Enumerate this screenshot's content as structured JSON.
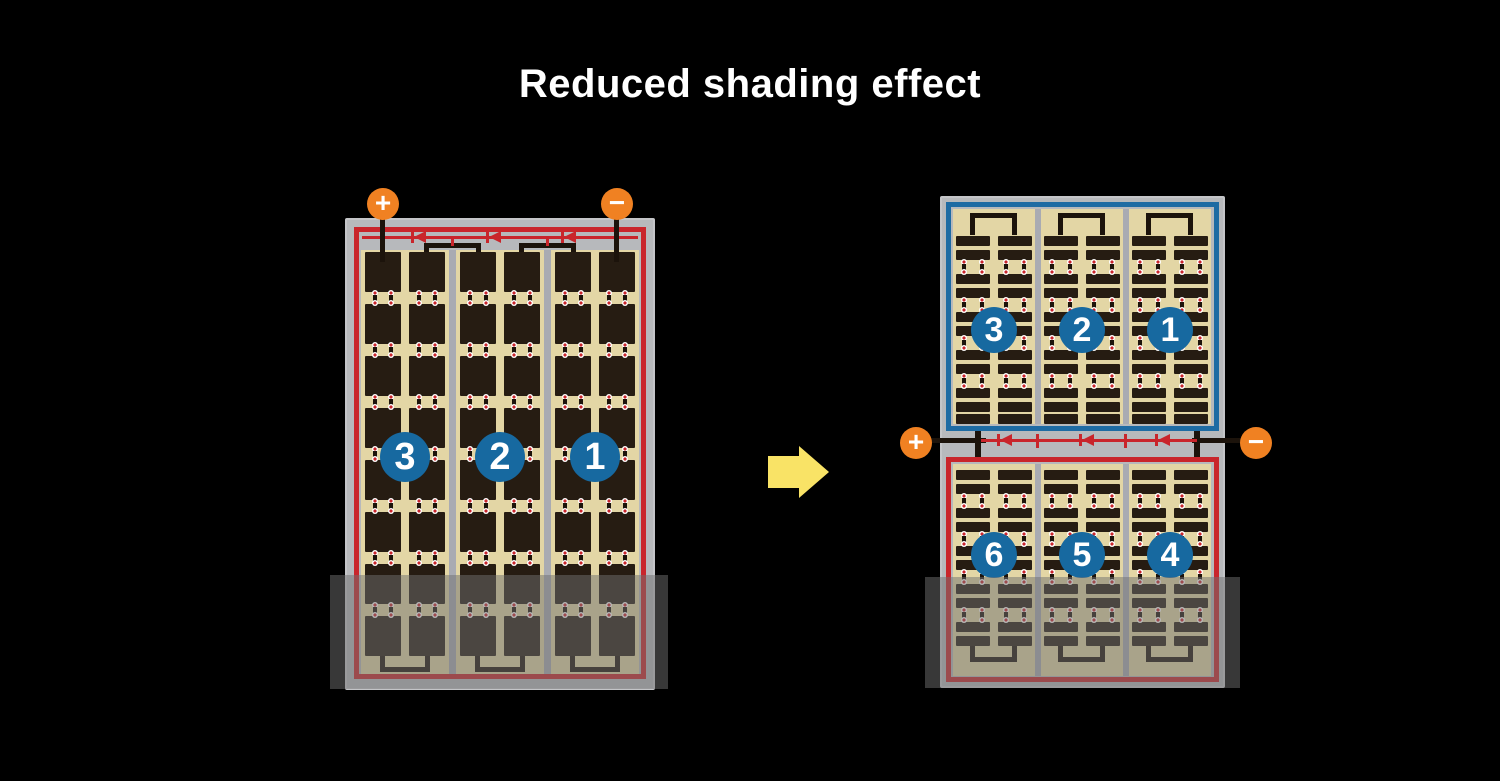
{
  "title": "Reduced shading effect",
  "colors": {
    "background": "#000000",
    "title_text": "#ffffff",
    "panel_frame": "#b7b9bc",
    "cell_area": "#e3d6a5",
    "cell": "#261c12",
    "divider": "#a9abb2",
    "circuit_red": "#c9252b",
    "circuit_blue": "#1e6ba3",
    "connector": "#1c130b",
    "number_badge": "#1769a0",
    "terminal": "#f08122",
    "arrow": "#f9e366",
    "shade": "rgba(112,112,112,0.5)"
  },
  "left_panel": {
    "terminals": {
      "positive": "+",
      "negative": "−"
    },
    "string_labels": [
      "3",
      "2",
      "1"
    ],
    "grid": {
      "groups": 3,
      "columns_per_group": 2,
      "rows": 8
    }
  },
  "right_panel": {
    "terminals": {
      "positive": "+",
      "negative": "−"
    },
    "top_string_labels": [
      "3",
      "2",
      "1"
    ],
    "bottom_string_labels": [
      "6",
      "5",
      "4"
    ],
    "grid": {
      "groups": 3,
      "columns_per_group": 2,
      "strip_rows_per_half": 11
    }
  }
}
